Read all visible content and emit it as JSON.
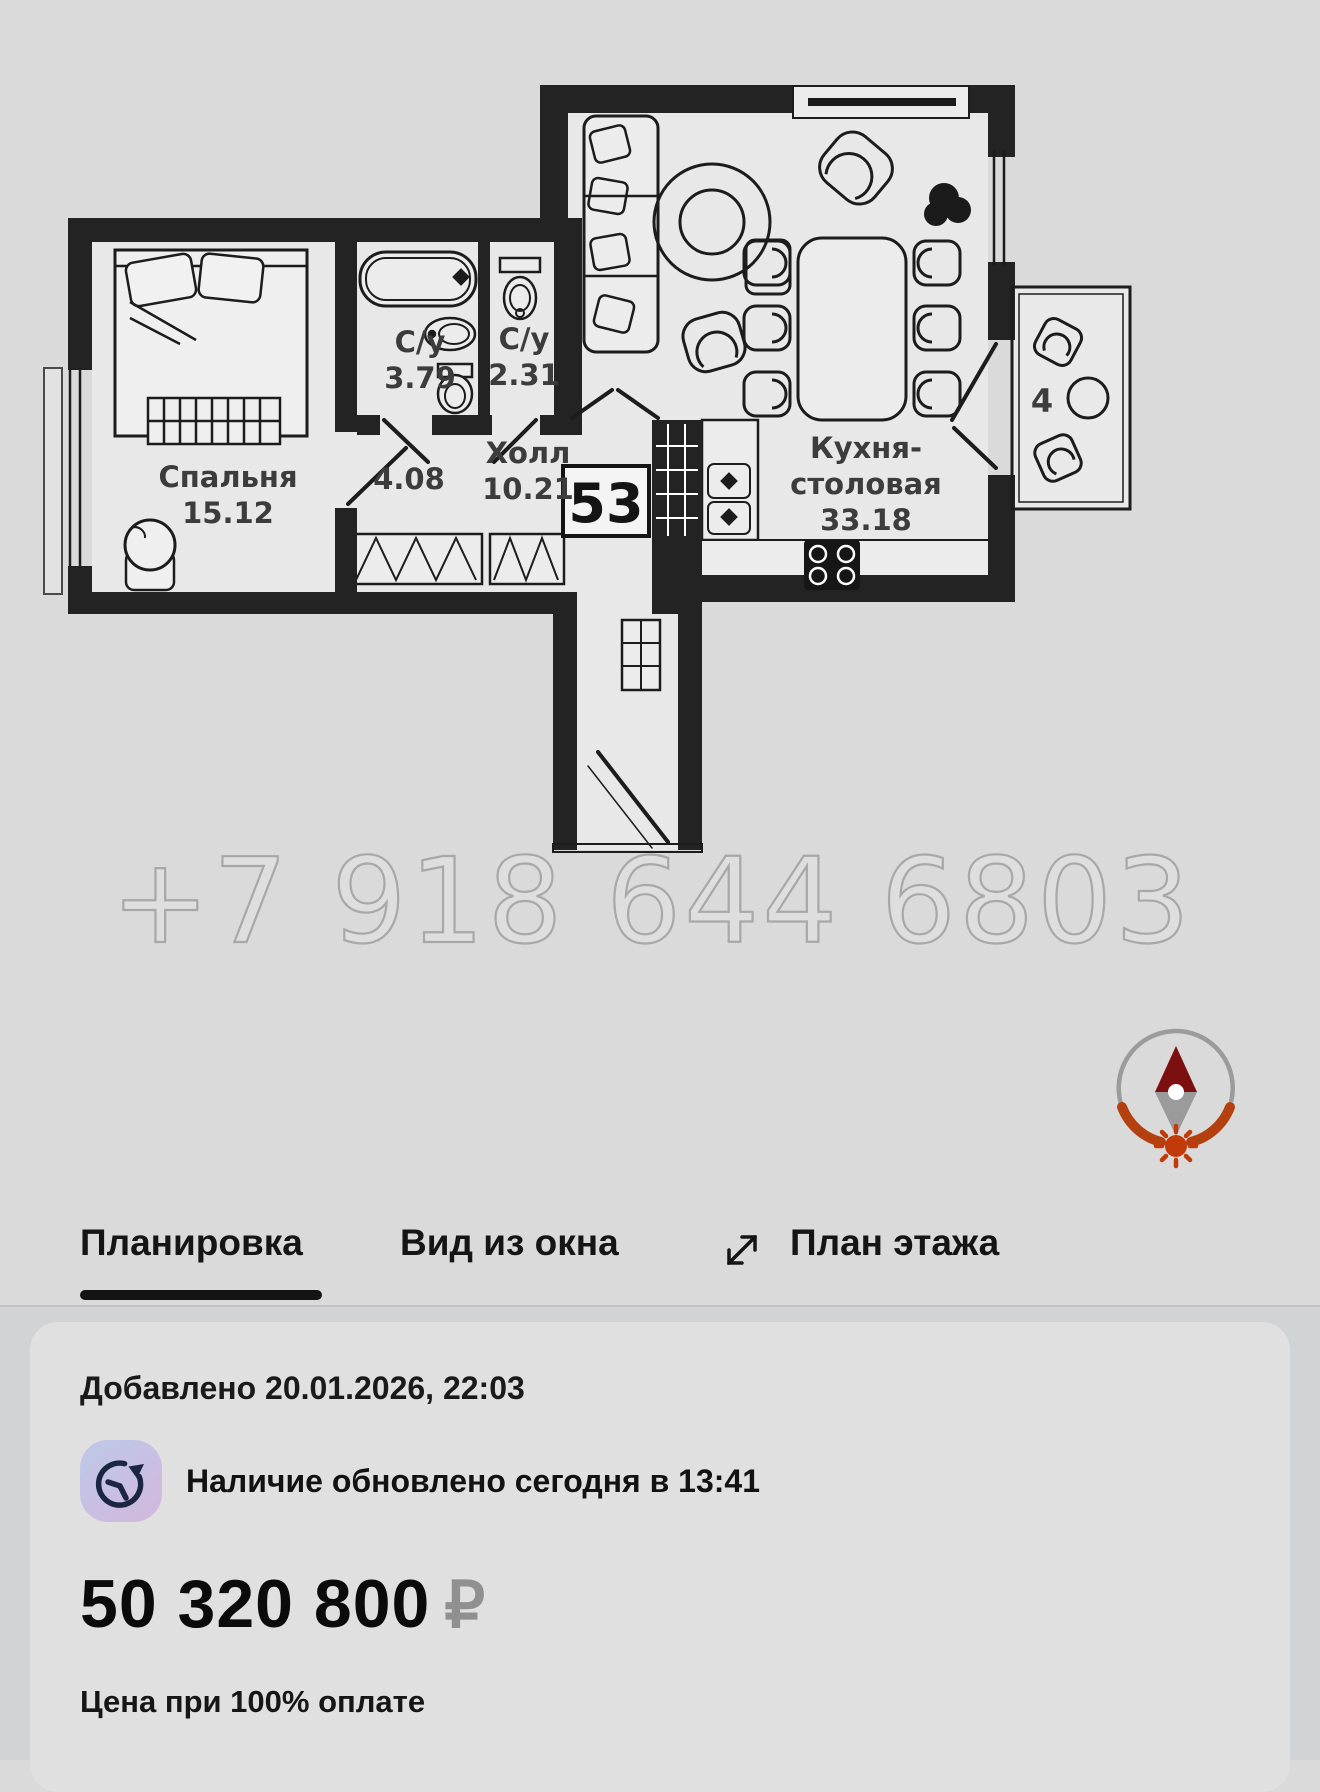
{
  "plan": {
    "watermark": "+7 918 644 6803",
    "unit_number": "53",
    "rooms": {
      "bedroom": {
        "name": "Спальня",
        "area": "15.12"
      },
      "bath1": {
        "name": "С/у",
        "area": "3.79"
      },
      "bath2": {
        "name": "С/у",
        "area": "2.31"
      },
      "hall": {
        "name": "Холл",
        "area": "10.21"
      },
      "corridor": {
        "area": "4.08"
      },
      "kitchen": {
        "name_line1": "Кухня-",
        "name_line2": "столовая",
        "area": "33.18"
      },
      "balcony": {
        "label": "4"
      }
    },
    "colors": {
      "walls": "#232323",
      "compass_ring_gray": "#9b9b9b",
      "compass_ring_rust": "#b5400f",
      "compass_needle_north": "#7c1010",
      "compass_sun": "#c23a0a"
    }
  },
  "tabs": {
    "layout": "Планировка",
    "view": "Вид из окна",
    "floor": "План этажа"
  },
  "card": {
    "added": "Добавлено 20.01.2026, 22:03",
    "availability": "Наличие обновлено сегодня в 13:41",
    "price": "50 320 800",
    "currency": "₽",
    "price_note": "Цена при 100% оплате"
  }
}
